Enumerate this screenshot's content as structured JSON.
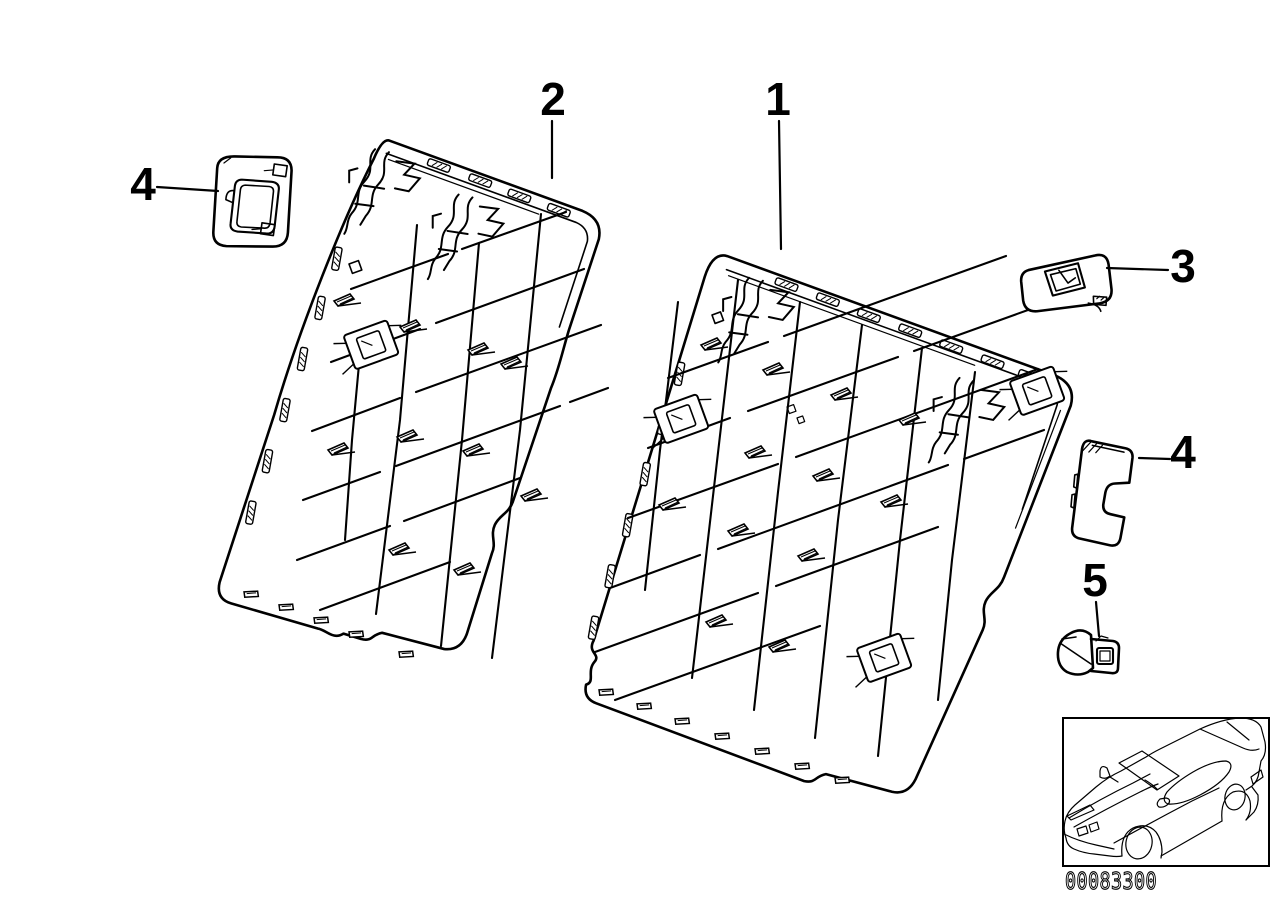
{
  "colors": {
    "background": "#ffffff",
    "line": "#000000"
  },
  "callouts": {
    "panel_right": {
      "label": "1"
    },
    "panel_left": {
      "label": "2"
    },
    "latch_cover": {
      "label": "3"
    },
    "cover_upper_left": {
      "label": "4"
    },
    "cover_right": {
      "label": "4"
    },
    "clip": {
      "label": "5"
    }
  },
  "footer": {
    "drawing_number": "00083300"
  },
  "icons": {
    "car_thumbnail": "car-outline-icon"
  }
}
